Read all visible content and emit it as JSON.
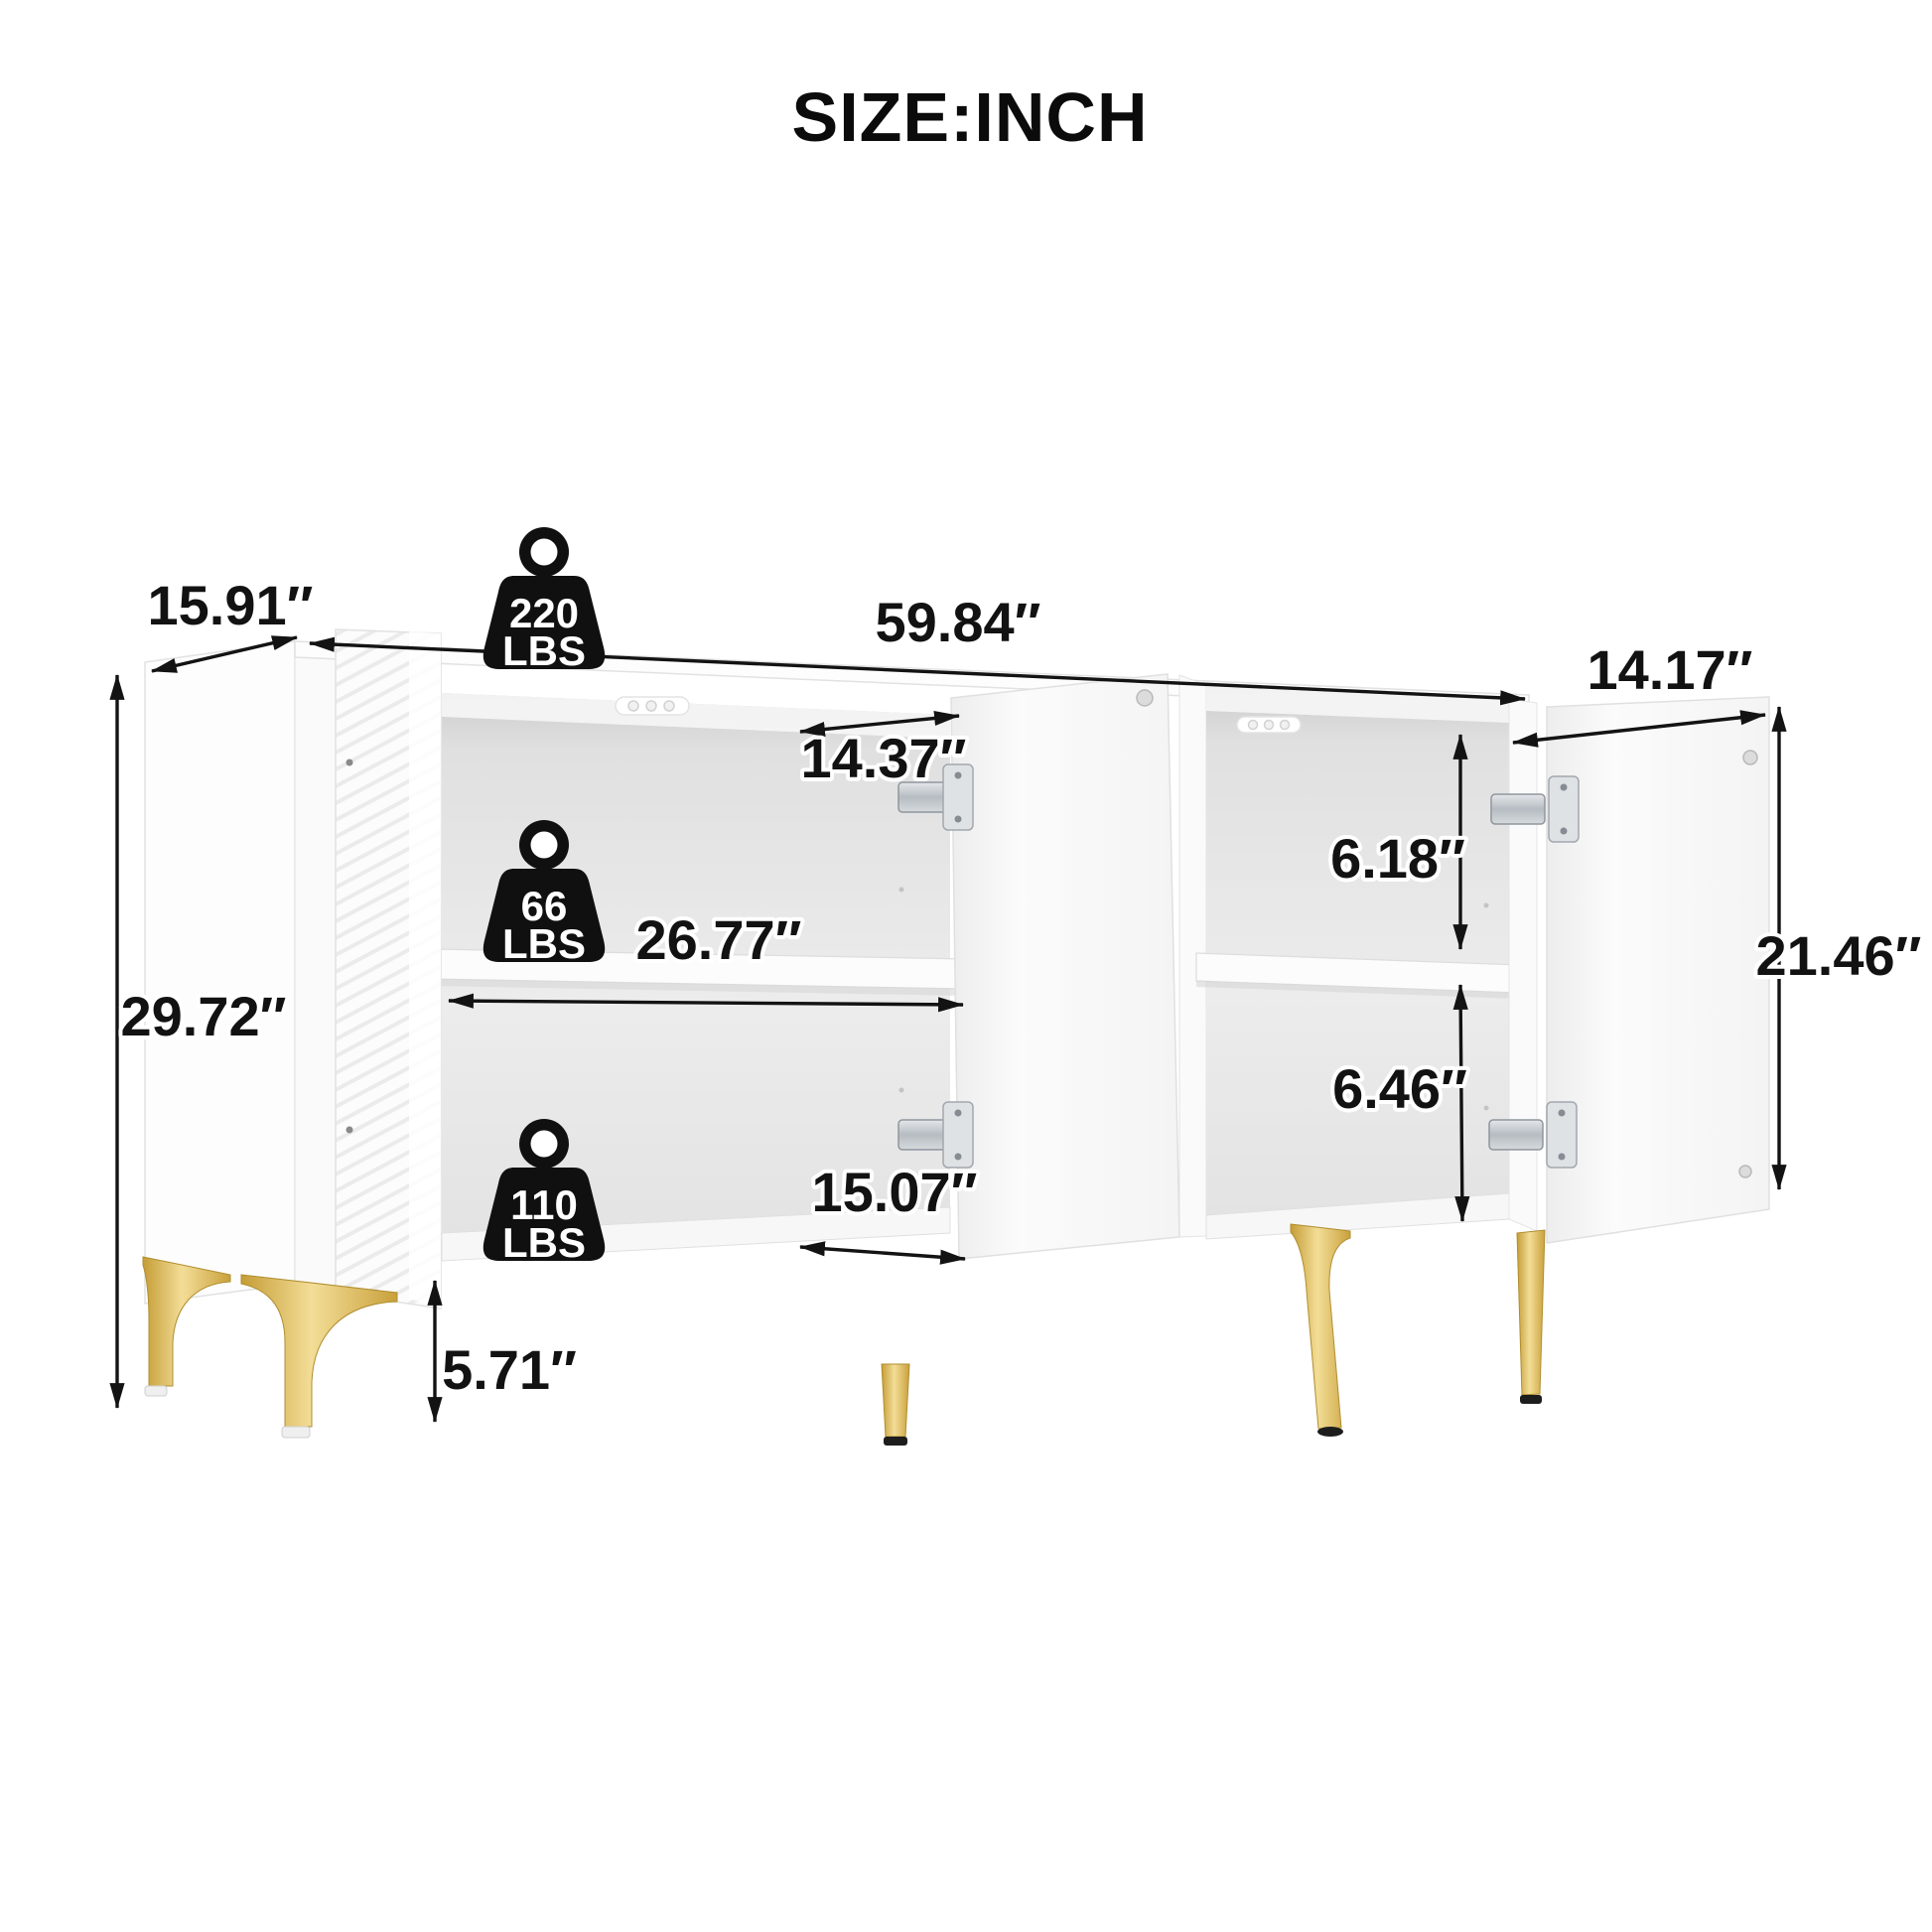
{
  "title": "SIZE:INCH",
  "illustration": {
    "product": "sideboard-cabinet-dimension-diagram",
    "colors": {
      "background": "#ffffff",
      "line": "#131313",
      "cabinet_white": "#fdfdfd",
      "interior_gray": "#e9e9e9",
      "leg_gold": "#d8b24a",
      "hinge_metal": "#bfc5ca"
    }
  },
  "dimensions": {
    "depth": "15.91″",
    "width": "59.84″",
    "right_door_width": "14.17″",
    "height": "29.72″",
    "left_opening_width": "14.37″",
    "shelf_span": "26.77″",
    "lower_opening_width": "15.07″",
    "right_upper_inner_height": "6.18″",
    "right_lower_inner_height": "6.46″",
    "door_height": "21.46″",
    "leg_height": "5.71″"
  },
  "load_capacity": {
    "top": {
      "value": "220",
      "unit": "LBS"
    },
    "shelf": {
      "value": "66",
      "unit": "LBS"
    },
    "bottom": {
      "value": "110",
      "unit": "LBS"
    }
  }
}
